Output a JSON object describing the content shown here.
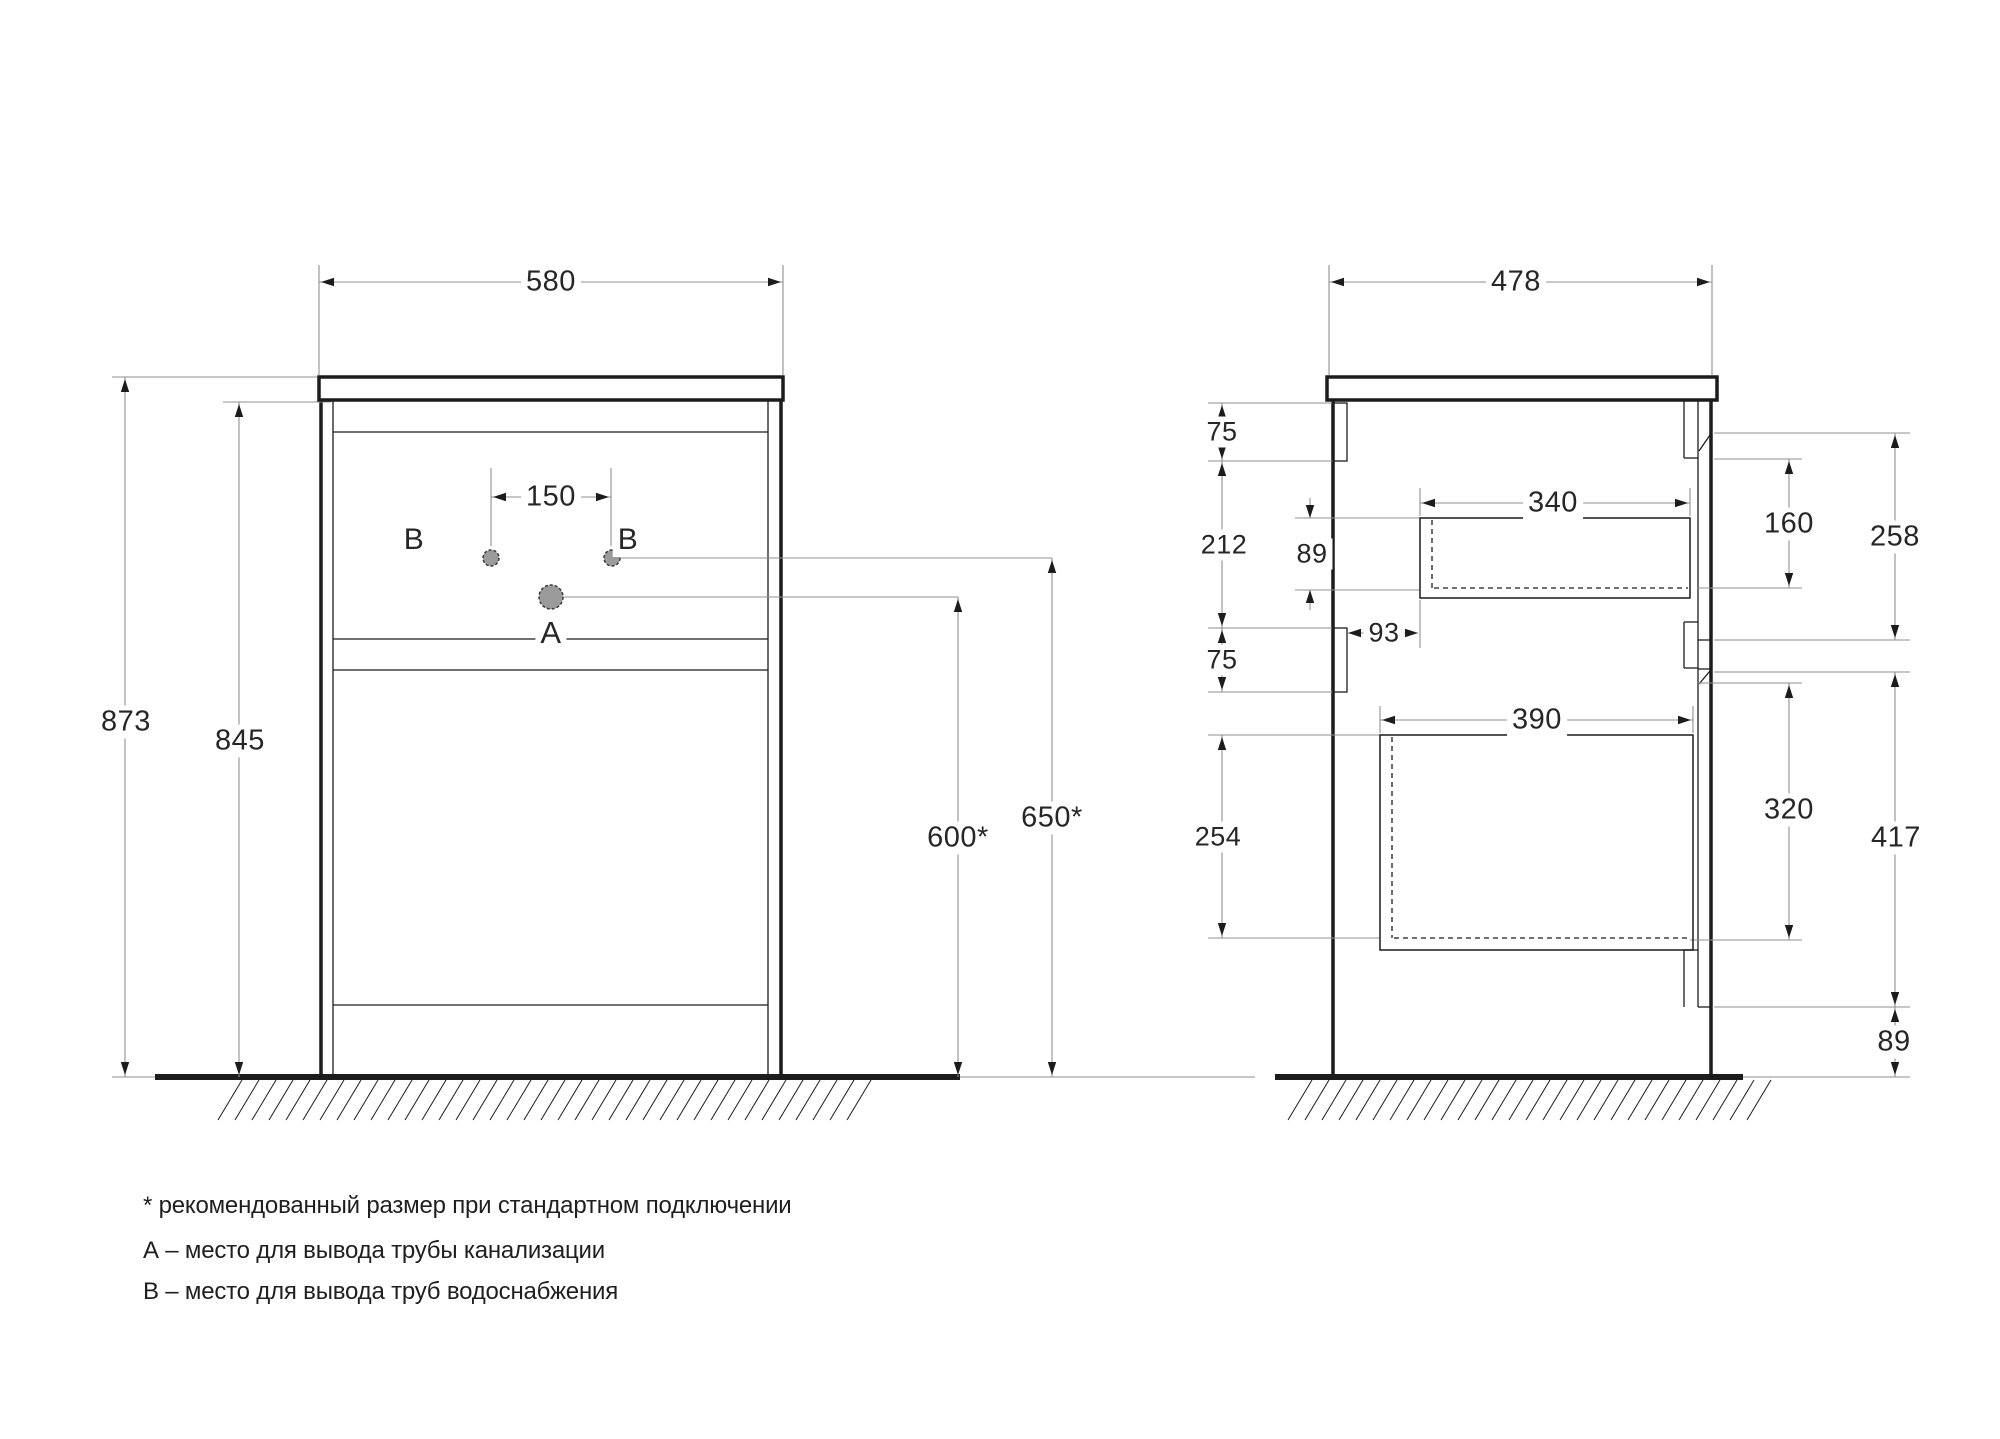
{
  "palette": {
    "background": "#ffffff",
    "object_line": "#1c1c1c",
    "dim_line": "#8f8f8f",
    "text_color": "#262626",
    "pipe_fill": "#9b9b9b",
    "pipe_stroke": "#3a3a3a"
  },
  "notes": {
    "line1": "* рекомендованный размер при стандартном подключении",
    "line2": "А – место для вывода трубы канализации",
    "line3": "В – место для вывода труб водоснабжения"
  },
  "drawing": {
    "rects": [
      {
        "x": 319,
        "y": 377,
        "w": 464,
        "h": 23,
        "sw": 3.5,
        "fill": "#ffffff",
        "n": "front-countertop"
      },
      {
        "x": 1327,
        "y": 377,
        "w": 390,
        "h": 23,
        "sw": 3.5,
        "fill": "#ffffff",
        "n": "side-countertop"
      },
      {
        "x": 1333,
        "y": 403,
        "w": 14,
        "h": 58,
        "sw": 1.3,
        "fill": "none",
        "n": "side-back-rail-top"
      },
      {
        "x": 1333,
        "y": 628,
        "w": 14,
        "h": 64,
        "sw": 1.3,
        "fill": "none",
        "n": "side-back-rail-middle"
      },
      {
        "x": 1420,
        "y": 518,
        "w": 270,
        "h": 80,
        "sw": 1.5,
        "fill": "none",
        "n": "side-drawer-top-outline"
      },
      {
        "x": 1380,
        "y": 735,
        "w": 313,
        "h": 215,
        "sw": 1.5,
        "fill": "none",
        "n": "side-drawer-bottom-outline"
      }
    ],
    "lines": [
      [
        321,
        400,
        321,
        1077,
        3.5,
        "o"
      ],
      [
        333,
        400,
        333,
        1077,
        1.3,
        "o"
      ],
      [
        781,
        400,
        781,
        1077,
        3.5,
        "o"
      ],
      [
        768,
        400,
        768,
        1077,
        1.3,
        "o"
      ],
      [
        333,
        432,
        768,
        432,
        1.3,
        "o"
      ],
      [
        333,
        639,
        768,
        639,
        1.3,
        "o"
      ],
      [
        333,
        670,
        768,
        670,
        1.3,
        "o"
      ],
      [
        333,
        1005,
        768,
        1005,
        1.3,
        "o"
      ],
      [
        155,
        1077,
        960,
        1077,
        6,
        "o"
      ],
      [
        1275,
        1077,
        1743,
        1077,
        6,
        "o"
      ],
      [
        1333,
        400,
        1333,
        1077,
        3.5,
        "o"
      ],
      [
        1711,
        400,
        1711,
        1077,
        3.5,
        "o"
      ],
      [
        1698,
        400,
        1698,
        1007,
        1.3,
        "o"
      ],
      [
        1684,
        400,
        1684,
        458,
        1.3,
        "o"
      ],
      [
        1684,
        458,
        1698,
        458,
        1.3,
        "o"
      ],
      [
        1684,
        622,
        1684,
        668,
        1.3,
        "o"
      ],
      [
        1684,
        622,
        1698,
        622,
        1.3,
        "o"
      ],
      [
        1684,
        668,
        1698,
        668,
        1.3,
        "o"
      ],
      [
        1684,
        950,
        1684,
        1007,
        1.3,
        "o"
      ],
      [
        1684,
        950,
        1698,
        950,
        1.3,
        "o"
      ],
      [
        1698,
        640,
        1711,
        640,
        1.3,
        "o"
      ],
      [
        1698,
        669,
        1711,
        669,
        1.3,
        "o"
      ],
      [
        1698,
        1007,
        1711,
        1007,
        1.3,
        "o"
      ],
      [
        1699,
        451,
        1710,
        435,
        1.3,
        "o"
      ],
      [
        1699,
        684,
        1710,
        671,
        1.3,
        "o"
      ],
      [
        319,
        265,
        319,
        375,
        1.1,
        "d"
      ],
      [
        783,
        265,
        783,
        375,
        1.1,
        "d"
      ],
      [
        319,
        282,
        783,
        282,
        1.1,
        "d"
      ],
      [
        112,
        377,
        317,
        377,
        1.1,
        "d"
      ],
      [
        125,
        377,
        125,
        1077,
        1.1,
        "d"
      ],
      [
        223,
        402,
        331,
        402,
        1.1,
        "d"
      ],
      [
        239,
        402,
        239,
        1077,
        1.1,
        "d"
      ],
      [
        491,
        468,
        491,
        546,
        1.1,
        "d"
      ],
      [
        611,
        468,
        611,
        546,
        1.1,
        "d"
      ],
      [
        491,
        497,
        611,
        497,
        1.1,
        "d"
      ],
      [
        620,
        558,
        1052,
        558,
        1.1,
        "d"
      ],
      [
        562,
        597,
        958,
        597,
        1.1,
        "d"
      ],
      [
        1052,
        558,
        1052,
        1077,
        1.1,
        "d"
      ],
      [
        958,
        597,
        958,
        1077,
        1.1,
        "d"
      ],
      [
        112,
        1077,
        155,
        1077,
        1.1,
        "d"
      ],
      [
        960,
        1077,
        1255,
        1077,
        1.1,
        "d"
      ],
      [
        1329,
        265,
        1329,
        375,
        1.1,
        "d"
      ],
      [
        1712,
        265,
        1712,
        375,
        1.1,
        "d"
      ],
      [
        1329,
        282,
        1712,
        282,
        1.1,
        "d"
      ],
      [
        1208,
        403,
        1332,
        403,
        1.1,
        "d"
      ],
      [
        1208,
        461,
        1347,
        461,
        1.1,
        "d"
      ],
      [
        1208,
        628,
        1332,
        628,
        1.1,
        "d"
      ],
      [
        1208,
        692,
        1347,
        692,
        1.1,
        "d"
      ],
      [
        1208,
        735,
        1380,
        735,
        1.1,
        "d"
      ],
      [
        1208,
        938,
        1380,
        938,
        1.1,
        "d"
      ],
      [
        1222,
        403,
        1222,
        461,
        1.1,
        "d"
      ],
      [
        1222,
        461,
        1222,
        628,
        1.1,
        "d"
      ],
      [
        1222,
        628,
        1222,
        692,
        1.1,
        "d"
      ],
      [
        1222,
        735,
        1222,
        938,
        1.1,
        "d"
      ],
      [
        1295,
        518,
        1420,
        518,
        1.1,
        "d"
      ],
      [
        1295,
        590,
        1420,
        590,
        1.1,
        "d"
      ],
      [
        1310,
        498,
        1310,
        518,
        1.1,
        "d"
      ],
      [
        1310,
        590,
        1310,
        610,
        1.1,
        "d"
      ],
      [
        1348,
        633,
        1418,
        633,
        1.1,
        "d"
      ],
      [
        1420,
        600,
        1420,
        648,
        1.1,
        "d"
      ],
      [
        1420,
        488,
        1420,
        516,
        1.1,
        "d"
      ],
      [
        1690,
        488,
        1690,
        516,
        1.1,
        "d"
      ],
      [
        1420,
        503,
        1690,
        503,
        1.1,
        "d"
      ],
      [
        1380,
        706,
        1380,
        733,
        1.1,
        "d"
      ],
      [
        1693,
        706,
        1693,
        733,
        1.1,
        "d"
      ],
      [
        1380,
        720,
        1693,
        720,
        1.1,
        "d"
      ],
      [
        1714,
        433,
        1910,
        433,
        1.1,
        "d"
      ],
      [
        1714,
        459,
        1802,
        459,
        1.1,
        "d"
      ],
      [
        1697,
        588,
        1802,
        588,
        1.1,
        "d"
      ],
      [
        1714,
        640,
        1910,
        640,
        1.1,
        "d"
      ],
      [
        1714,
        672,
        1910,
        672,
        1.1,
        "d"
      ],
      [
        1697,
        683,
        1802,
        683,
        1.1,
        "d"
      ],
      [
        1690,
        940,
        1802,
        940,
        1.1,
        "d"
      ],
      [
        1714,
        1007,
        1910,
        1007,
        1.1,
        "d"
      ],
      [
        1789,
        459,
        1789,
        588,
        1.1,
        "d"
      ],
      [
        1895,
        433,
        1895,
        640,
        1.1,
        "d"
      ],
      [
        1789,
        683,
        1789,
        940,
        1.1,
        "d"
      ],
      [
        1895,
        672,
        1895,
        1007,
        1.1,
        "d"
      ],
      [
        1895,
        1007,
        1895,
        1077,
        1.1,
        "d"
      ],
      [
        1743,
        1077,
        1910,
        1077,
        1.1,
        "d"
      ]
    ],
    "dashed_lines": [
      [
        1432,
        520,
        1432,
        588
      ],
      [
        1434,
        588,
        1688,
        588
      ],
      [
        1392,
        737,
        1392,
        938
      ],
      [
        1394,
        938,
        1691,
        938
      ]
    ],
    "arrows": [
      {
        "d": "left",
        "x": 321,
        "y": 282
      },
      {
        "d": "right",
        "x": 781,
        "y": 282
      },
      {
        "d": "left",
        "x": 1331,
        "y": 282
      },
      {
        "d": "right",
        "x": 1710,
        "y": 282
      },
      {
        "d": "left",
        "x": 493,
        "y": 497
      },
      {
        "d": "right",
        "x": 609,
        "y": 497
      },
      {
        "d": "up",
        "x": 125,
        "y": 379
      },
      {
        "d": "down",
        "x": 125,
        "y": 1075
      },
      {
        "d": "up",
        "x": 239,
        "y": 404
      },
      {
        "d": "down",
        "x": 239,
        "y": 1075
      },
      {
        "d": "up",
        "x": 958,
        "y": 599
      },
      {
        "d": "down",
        "x": 958,
        "y": 1075
      },
      {
        "d": "up",
        "x": 1052,
        "y": 560
      },
      {
        "d": "down",
        "x": 1052,
        "y": 1075
      },
      {
        "d": "up",
        "x": 1222,
        "y": 405
      },
      {
        "d": "down",
        "x": 1222,
        "y": 459
      },
      {
        "d": "up",
        "x": 1222,
        "y": 463
      },
      {
        "d": "down",
        "x": 1222,
        "y": 626
      },
      {
        "d": "up",
        "x": 1222,
        "y": 630
      },
      {
        "d": "down",
        "x": 1222,
        "y": 690
      },
      {
        "d": "up",
        "x": 1222,
        "y": 737
      },
      {
        "d": "down",
        "x": 1222,
        "y": 936
      },
      {
        "d": "down",
        "x": 1310,
        "y": 518
      },
      {
        "d": "up",
        "x": 1310,
        "y": 590
      },
      {
        "d": "left",
        "x": 1348,
        "y": 633
      },
      {
        "d": "right",
        "x": 1418,
        "y": 633
      },
      {
        "d": "left",
        "x": 1422,
        "y": 503
      },
      {
        "d": "right",
        "x": 1688,
        "y": 503
      },
      {
        "d": "left",
        "x": 1382,
        "y": 720
      },
      {
        "d": "right",
        "x": 1691,
        "y": 720
      },
      {
        "d": "up",
        "x": 1789,
        "y": 461
      },
      {
        "d": "down",
        "x": 1789,
        "y": 586
      },
      {
        "d": "up",
        "x": 1895,
        "y": 435
      },
      {
        "d": "down",
        "x": 1895,
        "y": 638
      },
      {
        "d": "up",
        "x": 1789,
        "y": 685
      },
      {
        "d": "down",
        "x": 1789,
        "y": 938
      },
      {
        "d": "up",
        "x": 1895,
        "y": 674
      },
      {
        "d": "down",
        "x": 1895,
        "y": 1005
      },
      {
        "d": "up",
        "x": 1895,
        "y": 1009
      },
      {
        "d": "down",
        "x": 1895,
        "y": 1075
      }
    ],
    "circles": [
      {
        "cx": 491,
        "cy": 558,
        "r": 8,
        "n": "water-supply-pipe-left"
      },
      {
        "cx": 612,
        "cy": 558,
        "r": 8,
        "n": "water-supply-pipe-right"
      },
      {
        "cx": 551,
        "cy": 597,
        "r": 12,
        "n": "drain-pipe"
      }
    ],
    "hatch": [
      {
        "x1": 218,
        "x2": 858,
        "yTop": 1080,
        "yBot": 1120,
        "step": 17,
        "dx": 24,
        "n": "floor-hatch-front-view"
      },
      {
        "x1": 1288,
        "x2": 1762,
        "yTop": 1080,
        "yBot": 1120,
        "step": 17,
        "dx": 24,
        "n": "floor-hatch-side-view"
      }
    ],
    "labels": [
      {
        "t": "580",
        "x": 551,
        "y": 282,
        "fs": 29,
        "n": "dim-label-580"
      },
      {
        "t": "478",
        "x": 1516,
        "y": 282,
        "fs": 29,
        "n": "dim-label-478"
      },
      {
        "t": "873",
        "x": 126,
        "y": 722,
        "fs": 29,
        "n": "dim-label-873"
      },
      {
        "t": "845",
        "x": 240,
        "y": 741,
        "fs": 29,
        "n": "dim-label-845"
      },
      {
        "t": "150",
        "x": 551,
        "y": 497,
        "fs": 29,
        "n": "dim-label-150"
      },
      {
        "t": "B",
        "x": 414,
        "y": 540,
        "fs": 30,
        "n": "pipe-label-b-left"
      },
      {
        "t": "B",
        "x": 628,
        "y": 540,
        "fs": 30,
        "n": "pipe-label-b-right"
      },
      {
        "t": "A",
        "x": 551,
        "y": 633,
        "fs": 31,
        "n": "pipe-label-a"
      },
      {
        "t": "600*",
        "x": 958,
        "y": 838,
        "fs": 29,
        "n": "dim-label-600"
      },
      {
        "t": "650*",
        "x": 1052,
        "y": 818,
        "fs": 29,
        "n": "dim-label-650"
      },
      {
        "t": "75",
        "x": 1222,
        "y": 432,
        "fs": 27,
        "n": "dim-label-75-top"
      },
      {
        "t": "212",
        "x": 1224,
        "y": 545,
        "fs": 27,
        "n": "dim-label-212"
      },
      {
        "t": "89",
        "x": 1312,
        "y": 554,
        "fs": 27,
        "n": "dim-label-89-drawer"
      },
      {
        "t": "75",
        "x": 1222,
        "y": 660,
        "fs": 27,
        "n": "dim-label-75-middle"
      },
      {
        "t": "93",
        "x": 1384,
        "y": 633,
        "fs": 27,
        "n": "dim-label-93"
      },
      {
        "t": "254",
        "x": 1218,
        "y": 837,
        "fs": 27,
        "n": "dim-label-254"
      },
      {
        "t": "340",
        "x": 1553,
        "y": 503,
        "fs": 29,
        "n": "dim-label-340"
      },
      {
        "t": "160",
        "x": 1789,
        "y": 524,
        "fs": 29,
        "n": "dim-label-160"
      },
      {
        "t": "258",
        "x": 1895,
        "y": 537,
        "fs": 29,
        "n": "dim-label-258"
      },
      {
        "t": "390",
        "x": 1537,
        "y": 720,
        "fs": 29,
        "n": "dim-label-390"
      },
      {
        "t": "320",
        "x": 1789,
        "y": 810,
        "fs": 29,
        "n": "dim-label-320"
      },
      {
        "t": "417",
        "x": 1896,
        "y": 838,
        "fs": 29,
        "n": "dim-label-417"
      },
      {
        "t": "89",
        "x": 1894,
        "y": 1042,
        "fs": 29,
        "n": "dim-label-89-bottom"
      }
    ]
  }
}
